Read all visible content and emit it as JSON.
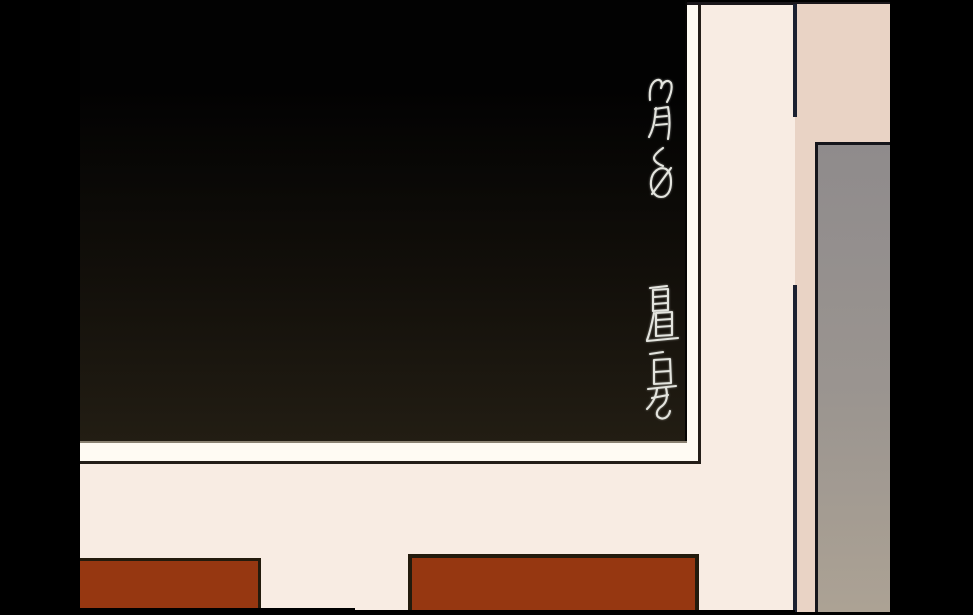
{
  "chalkboard": {
    "date_text": "3月6日",
    "note_text": "置是"
  },
  "colors": {
    "letterbox": "#000000",
    "board_top": "#020202",
    "board_mid": "#120f0a",
    "board_bottom": "#221d13",
    "frame_white": "#fffbf3",
    "frame_outline": "#241e19",
    "tray_edge": "#8a8272",
    "wall_cream": "#f8ece3",
    "wall_tan": "#e9d3c5",
    "wall_outline": "#1a161a",
    "corner_line": "#1b2030",
    "door_gray_top": "#8f8b8c",
    "door_gray_bottom": "#aca294",
    "door_outline": "#15151b",
    "desk_brown": "#963711",
    "desk_outline": "#231b0d",
    "chalk": "#e3e4de"
  }
}
